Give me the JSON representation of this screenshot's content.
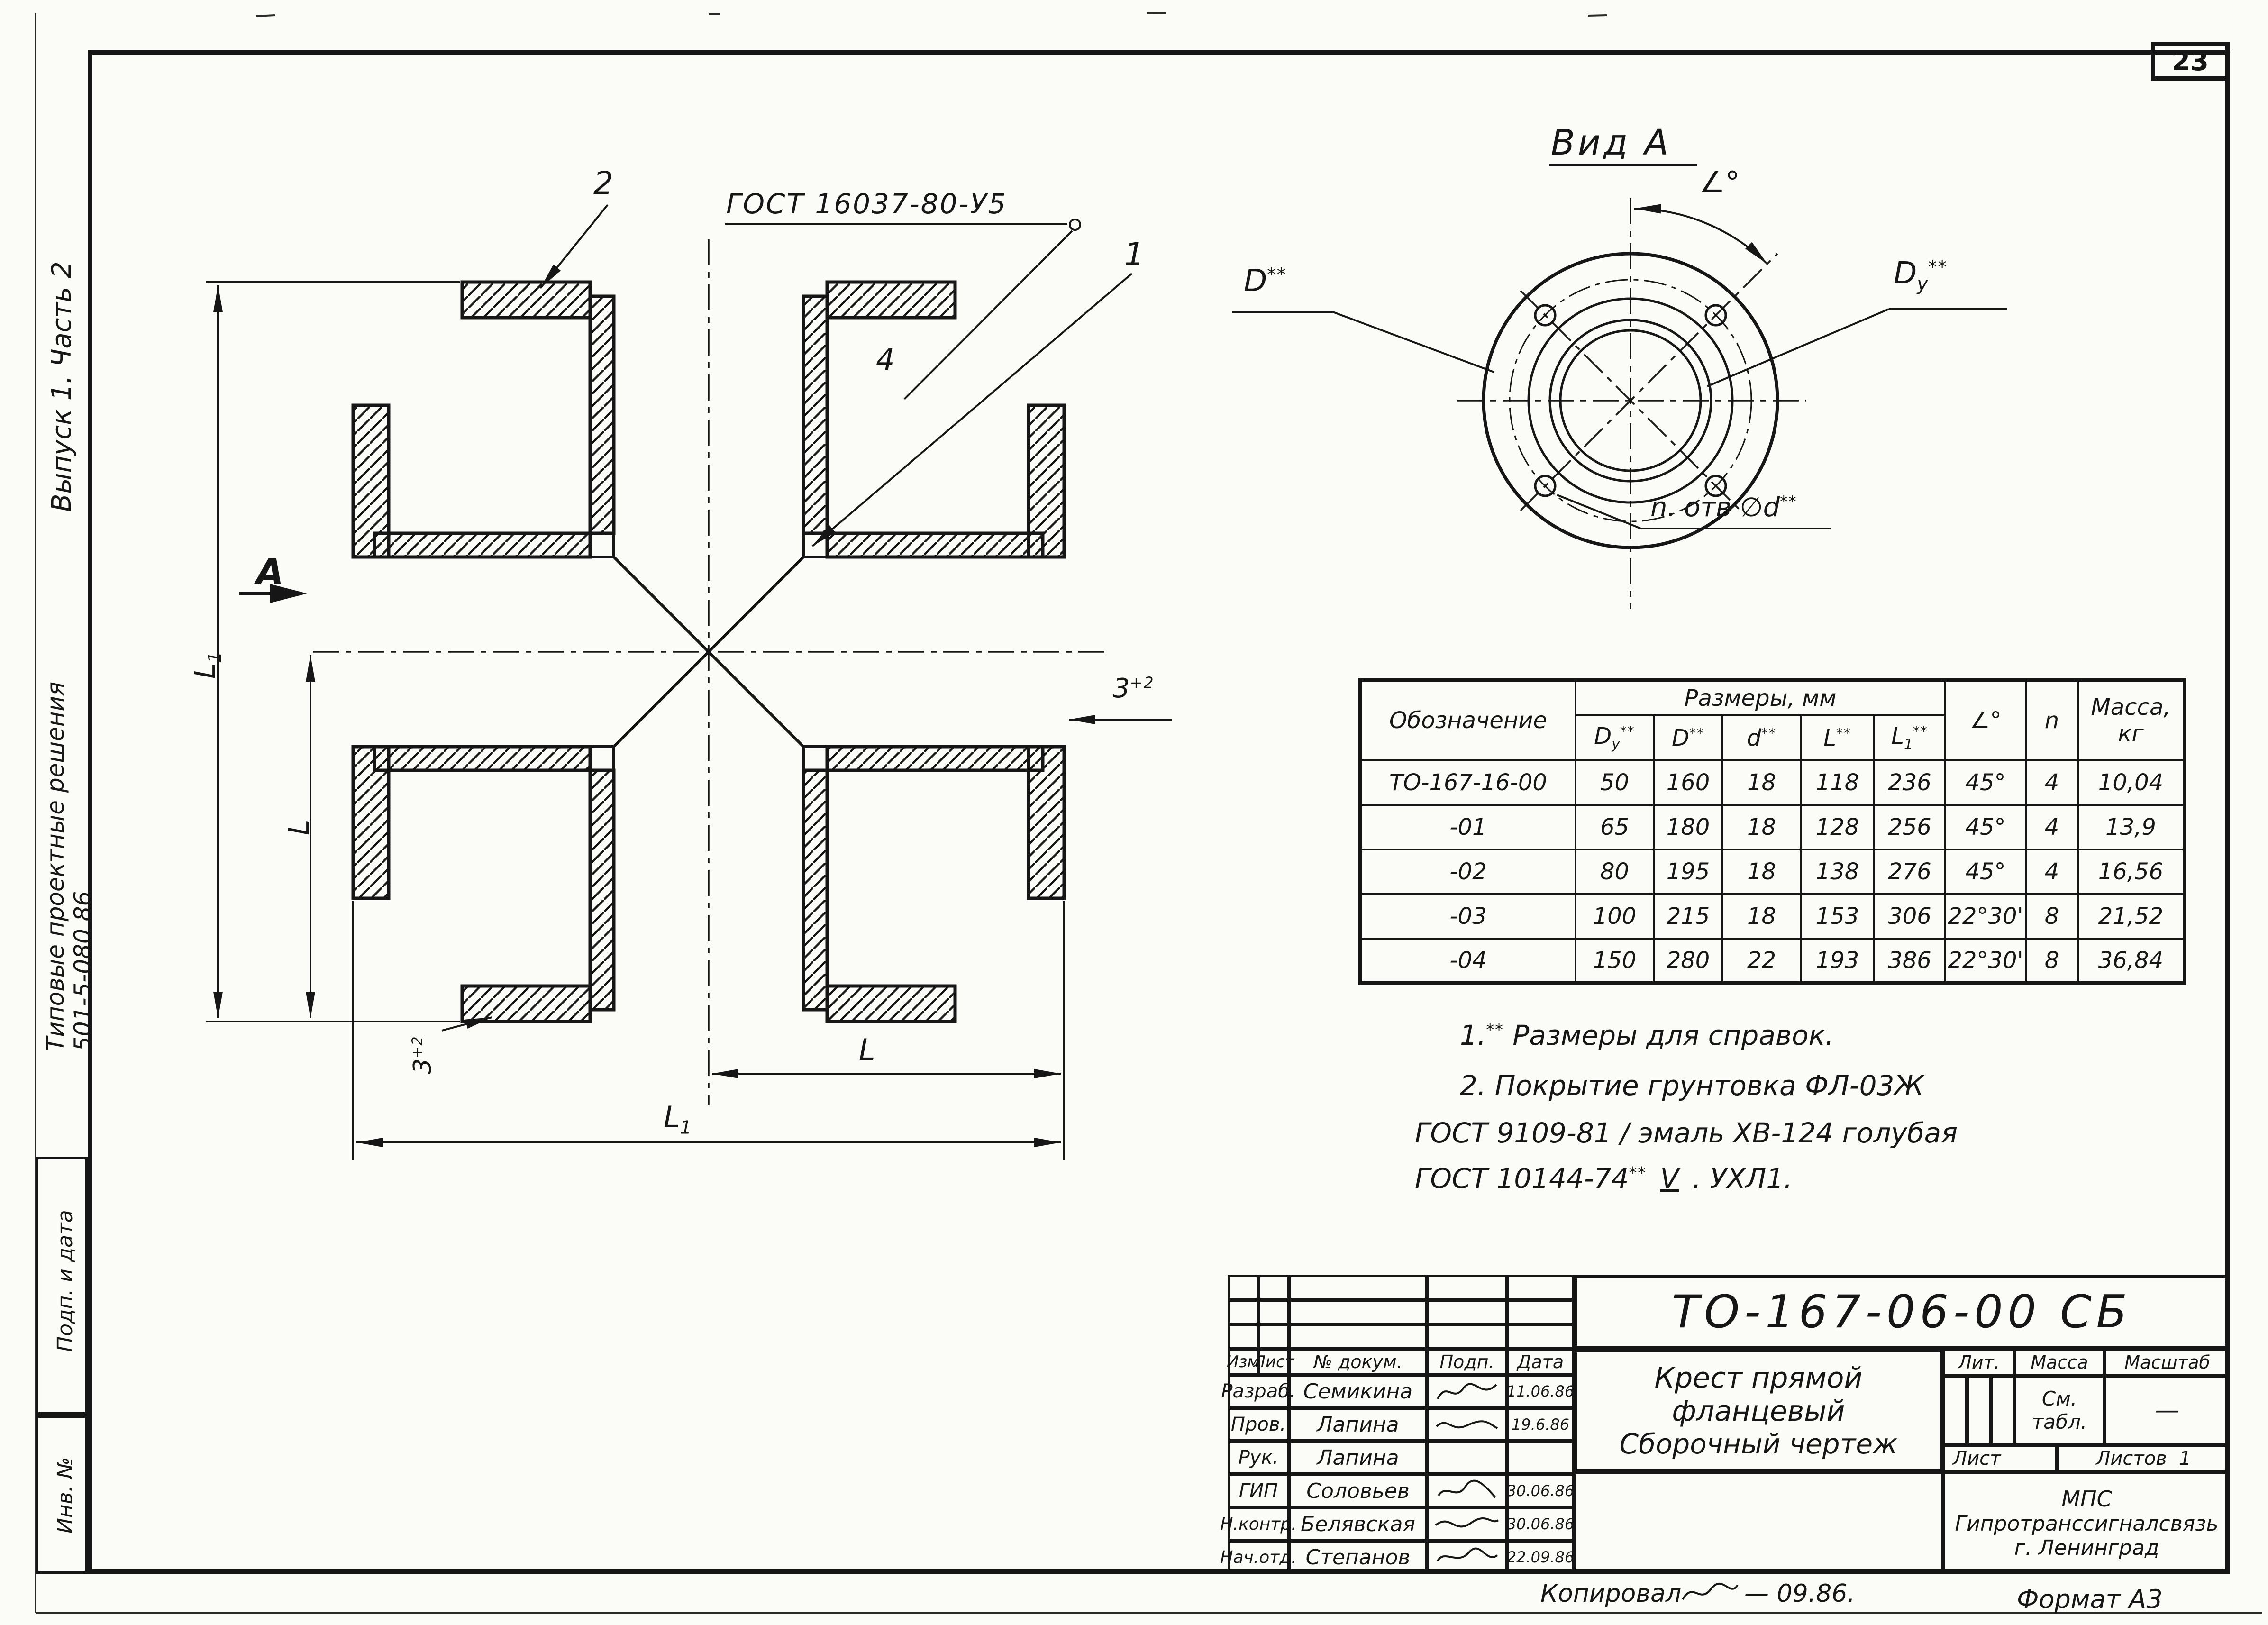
{
  "colors": {
    "ink": "#161616",
    "paper": "#fbfbf8"
  },
  "page": {
    "number": "23",
    "format_note": "Формат А3",
    "copied_label": "Копировал",
    "copied_date": "— 09.86."
  },
  "margin": {
    "issue": "Выпуск 1. Часть 2",
    "series": "Типовые проектные решения",
    "code": "501-5-080.86",
    "box_sign": "Подп. и дата",
    "box_inv": "Инв. №"
  },
  "drawing": {
    "gost_callout": "ГОСТ 16037-80-У5",
    "pos1": "1",
    "pos2": "2",
    "pos4": "4",
    "view_arrow_label": "А",
    "dim_L": "L",
    "dim_L1_main": "L",
    "dim_L1_sub": "1",
    "gap_base": "3",
    "gap_sup": "+2"
  },
  "view_a": {
    "title": "Вид А",
    "angle_label": "∠°",
    "d_main": "D",
    "d_note": "**",
    "dy_main": "D",
    "dy_sub": "у",
    "dy_note": "**",
    "holes_prefix": "n. отв ∅d",
    "holes_note": "**"
  },
  "table": {
    "col_designation": "Обозначение",
    "group_sizes": "Размеры, мм",
    "h_dy": {
      "main": "D",
      "sub": "у",
      "note": "**"
    },
    "h_d": {
      "main": "D",
      "note": "**"
    },
    "h_dsmall": {
      "main": "d",
      "note": "**"
    },
    "h_l": {
      "main": "L",
      "note": "**"
    },
    "h_l1": {
      "main": "L",
      "sub": "1",
      "note": "**"
    },
    "h_angle": "∠°",
    "h_n": "n",
    "h_mass_1": "Масса,",
    "h_mass_2": "кг",
    "rows": [
      [
        "ТО-167-16-00",
        "50",
        "160",
        "18",
        "118",
        "236",
        "45°",
        "4",
        "10,04"
      ],
      [
        "-01",
        "65",
        "180",
        "18",
        "128",
        "256",
        "45°",
        "4",
        "13,9"
      ],
      [
        "-02",
        "80",
        "195",
        "18",
        "138",
        "276",
        "45°",
        "4",
        "16,56"
      ],
      [
        "-03",
        "100",
        "215",
        "18",
        "153",
        "306",
        "22°30'",
        "8",
        "21,52"
      ],
      [
        "-04",
        "150",
        "280",
        "22",
        "193",
        "386",
        "22°30'",
        "8",
        "36,84"
      ]
    ]
  },
  "notes": {
    "n1_num": "1.",
    "n1_sup": "**",
    "n1_text": " Размеры для справок.",
    "n2": "2. Покрытие  грунтовка  ФЛ-03Ж",
    "n3": "ГОСТ 9109-81 / эмаль ХВ-124  голубая",
    "n4_a": "ГОСТ 10144-74",
    "n4_sup": "**",
    "n4_v": "V",
    "n4_b": ". УХЛ1."
  },
  "titleblock": {
    "designation": "ТО-167-06-00 СБ",
    "title_1": "Крест прямой",
    "title_2": "фланцевый",
    "title_3": "Сборочный чертеж",
    "rev_headers": [
      "Изм",
      "Лист",
      "№ докум.",
      "Подп.",
      "Дата"
    ],
    "roles": [
      {
        "role": "Разраб.",
        "name": "Семикина",
        "date": "11.06.86"
      },
      {
        "role": "Пров.",
        "name": "Лапина",
        "date": "19.6.86"
      },
      {
        "role": "Рук.",
        "name": "Лапина",
        "date": ""
      },
      {
        "role": "ГИП",
        "name": "Соловьев",
        "date": "30.06.86"
      },
      {
        "role": "Н.контр.",
        "name": "Белявская",
        "date": "30.06.86"
      },
      {
        "role": "Нач.отд.",
        "name": "Степанов",
        "date": "22.09.86"
      }
    ],
    "lit_label": "Лит.",
    "mass_label": "Масса",
    "scale_label": "Масштаб",
    "mass_value_1": "См.",
    "mass_value_2": "табл.",
    "scale_value": "—",
    "sheet_label": "Лист",
    "sheets_label": "Листов",
    "sheets_value": "1",
    "org_1": "МПС",
    "org_2": "Гипротранссигналсвязь",
    "org_3": "г. Ленинград"
  }
}
